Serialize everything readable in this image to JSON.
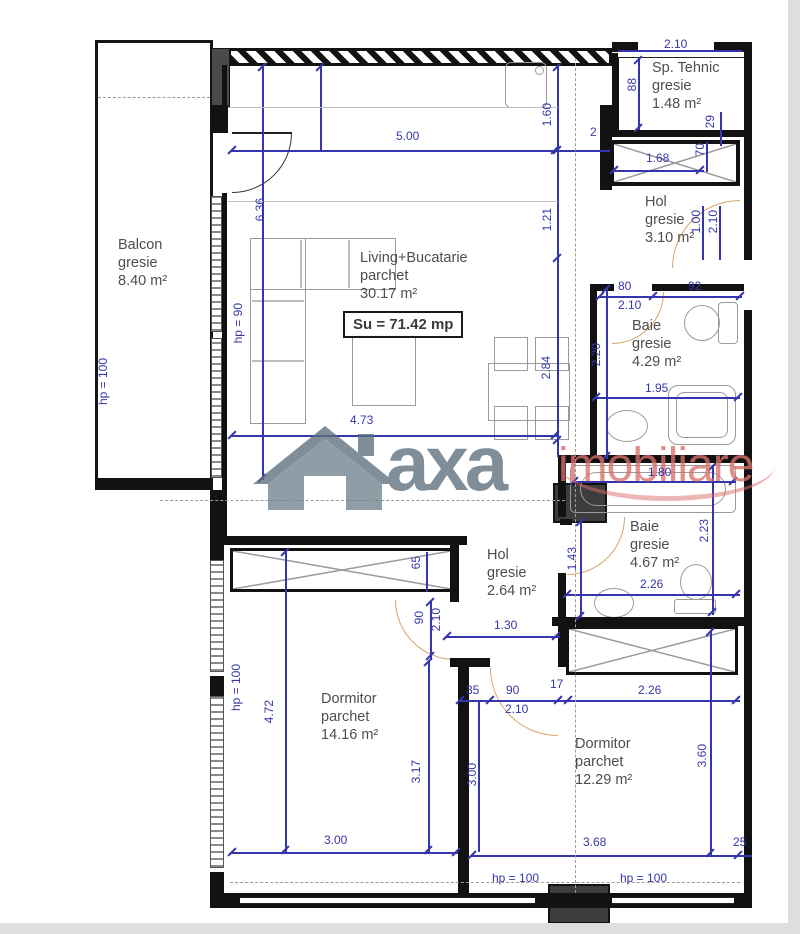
{
  "plan": {
    "su_label": "Su = 71.42 mp",
    "watermark": {
      "logo": "house-icon",
      "brand": "axa",
      "suffix": "imobiliare"
    },
    "colors": {
      "dimension_blue": "#3636ac",
      "wall_black": "#121212",
      "label_gray": "#4e4e4e",
      "door_tan": "#d8a468",
      "watermark_gray": "#5d6f7d",
      "watermark_red": "#d9706b"
    },
    "rooms": [
      {
        "id": "balcon",
        "name": "Balcon",
        "finish": "gresie",
        "area": "8.40 m²",
        "x": 118,
        "y": 237
      },
      {
        "id": "living",
        "name": "Living+Bucatarie",
        "finish": "parchet",
        "area": "30.17 m²",
        "x": 360,
        "y": 250
      },
      {
        "id": "sp-tehnic",
        "name": "Sp. Tehnic",
        "finish": "gresie",
        "area": "1.48 m²",
        "x": 652,
        "y": 60
      },
      {
        "id": "hol-1",
        "name": "Hol",
        "finish": "gresie",
        "area": "3.10 m²",
        "x": 645,
        "y": 194
      },
      {
        "id": "baie-1",
        "name": "Baie",
        "finish": "gresie",
        "area": "4.29 m²",
        "x": 632,
        "y": 318
      },
      {
        "id": "baie-2",
        "name": "Baie",
        "finish": "gresie",
        "area": "4.67 m²",
        "x": 630,
        "y": 519
      },
      {
        "id": "hol-2",
        "name": "Hol",
        "finish": "gresie",
        "area": "2.64 m²",
        "x": 487,
        "y": 547
      },
      {
        "id": "dormitor-1",
        "name": "Dormitor",
        "finish": "parchet",
        "area": "14.16 m²",
        "x": 321,
        "y": 691
      },
      {
        "id": "dormitor-2",
        "name": "Dormitor",
        "finish": "parchet",
        "area": "12.29 m²",
        "x": 575,
        "y": 736
      }
    ],
    "dims": [
      {
        "t": "2.10",
        "x": 664,
        "y": 38
      },
      {
        "t": "88",
        "x": 626,
        "y": 78,
        "r": 1
      },
      {
        "t": "5.00",
        "x": 396,
        "y": 130
      },
      {
        "t": "1.60",
        "x": 541,
        "y": 103,
        "r": 1
      },
      {
        "t": "2",
        "x": 590,
        "y": 126
      },
      {
        "t": "29",
        "x": 704,
        "y": 115,
        "r": 1
      },
      {
        "t": "1.68",
        "x": 646,
        "y": 152
      },
      {
        "t": "70",
        "x": 694,
        "y": 143,
        "r": 1
      },
      {
        "t": "1.21",
        "x": 541,
        "y": 208,
        "r": 1
      },
      {
        "t": "1.00",
        "x": 690,
        "y": 210,
        "r": 1
      },
      {
        "t": "2.10",
        "x": 707,
        "y": 210,
        "r": 1
      },
      {
        "t": "80",
        "x": 618,
        "y": 280
      },
      {
        "t": "92",
        "x": 688,
        "y": 280
      },
      {
        "t": "2.10",
        "x": 618,
        "y": 299
      },
      {
        "t": "6.36",
        "x": 254,
        "y": 198,
        "r": 1
      },
      {
        "t": "hp = 90",
        "x": 232,
        "y": 303,
        "r": 1
      },
      {
        "t": "hp = 100",
        "x": 97,
        "y": 358,
        "r": 1
      },
      {
        "t": "2.20",
        "x": 590,
        "y": 343,
        "r": 1
      },
      {
        "t": "2.84",
        "x": 540,
        "y": 356,
        "r": 1
      },
      {
        "t": "1.95",
        "x": 645,
        "y": 382
      },
      {
        "t": "4.73",
        "x": 350,
        "y": 414
      },
      {
        "t": "1.80",
        "x": 648,
        "y": 466
      },
      {
        "t": "2.23",
        "x": 698,
        "y": 519,
        "r": 1
      },
      {
        "t": "1.43",
        "x": 566,
        "y": 547,
        "r": 1
      },
      {
        "t": "2.26",
        "x": 640,
        "y": 578
      },
      {
        "t": "65",
        "x": 410,
        "y": 556,
        "r": 1
      },
      {
        "t": "90",
        "x": 413,
        "y": 611,
        "r": 1
      },
      {
        "t": "2.10",
        "x": 430,
        "y": 608,
        "r": 1
      },
      {
        "t": "1.30",
        "x": 494,
        "y": 619
      },
      {
        "t": "35",
        "x": 466,
        "y": 684
      },
      {
        "t": "90",
        "x": 506,
        "y": 684
      },
      {
        "t": "17",
        "x": 550,
        "y": 678
      },
      {
        "t": "2.10",
        "x": 505,
        "y": 703
      },
      {
        "t": "2.26",
        "x": 638,
        "y": 684
      },
      {
        "t": "hp = 100",
        "x": 230,
        "y": 664,
        "r": 1
      },
      {
        "t": "4.72",
        "x": 263,
        "y": 700,
        "r": 1
      },
      {
        "t": "3.17",
        "x": 410,
        "y": 760,
        "r": 1
      },
      {
        "t": "3.00",
        "x": 466,
        "y": 763,
        "r": 1
      },
      {
        "t": "3.60",
        "x": 696,
        "y": 744,
        "r": 1
      },
      {
        "t": "3.00",
        "x": 324,
        "y": 834
      },
      {
        "t": "3.68",
        "x": 583,
        "y": 836
      },
      {
        "t": "25",
        "x": 733,
        "y": 836
      },
      {
        "t": "hp = 100",
        "x": 492,
        "y": 872
      },
      {
        "t": "hp = 100",
        "x": 620,
        "y": 872
      }
    ]
  }
}
